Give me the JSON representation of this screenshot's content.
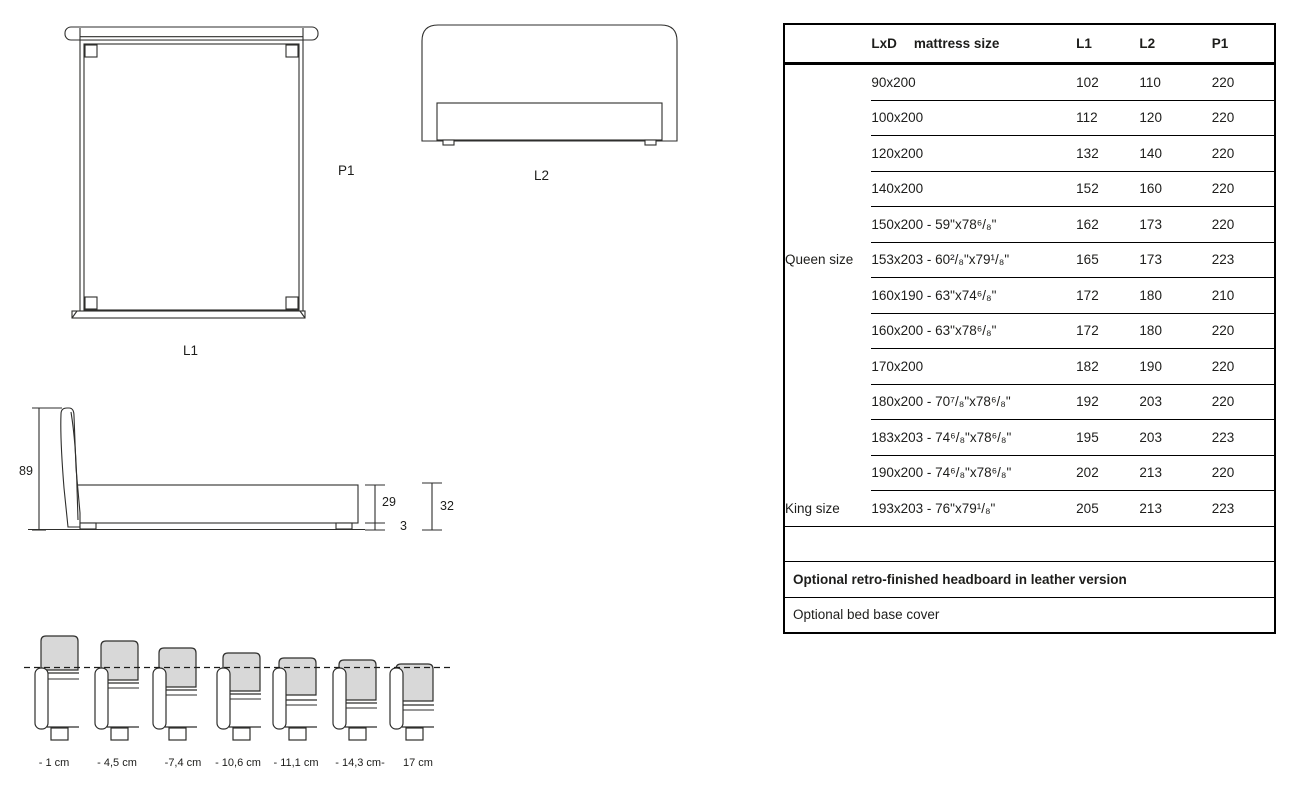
{
  "colors": {
    "ink": "#1d1d1b",
    "line": "#2e2e2c",
    "gray_fill": "#d8d8d8",
    "table_border": "#000000"
  },
  "drawings": {
    "top_view": {
      "bottom_label": "L1",
      "side_label": "P1"
    },
    "front_view": {
      "bottom_label": "L2"
    },
    "side_view": {
      "total_height": "89",
      "base_height": "29",
      "foot_height": "3",
      "base_with_foot": "32"
    }
  },
  "headboard_profiles": {
    "dashed_line_y": 668,
    "items": [
      {
        "label": "- 1 cm",
        "rail_x": 35,
        "gray_top": 636,
        "gray_bottom": 670,
        "seam1": 673,
        "seam2": 679,
        "label_x": 54
      },
      {
        "label": "- 4,5 cm",
        "rail_x": 95,
        "gray_top": 641,
        "gray_bottom": 680,
        "seam1": 683,
        "seam2": 688,
        "label_x": 117
      },
      {
        "label": "-7,4 cm",
        "rail_x": 153,
        "gray_top": 648,
        "gray_bottom": 687,
        "seam1": 690,
        "seam2": 695,
        "label_x": 183
      },
      {
        "label": "- 10,6 cm",
        "rail_x": 217,
        "gray_top": 653,
        "gray_bottom": 691,
        "seam1": 694,
        "seam2": 699,
        "label_x": 238
      },
      {
        "label": "- 11,1 cm",
        "rail_x": 273,
        "gray_top": 658,
        "gray_bottom": 695,
        "seam1": 700,
        "seam2": 705,
        "label_x": 296
      },
      {
        "label": "- 14,3 cm-",
        "rail_x": 333,
        "gray_top": 660,
        "gray_bottom": 700,
        "seam1": 703,
        "seam2": 708,
        "label_x": 360
      },
      {
        "label": "17 cm",
        "rail_x": 390,
        "gray_top": 664,
        "gray_bottom": 701,
        "seam1": 705,
        "seam2": 710,
        "label_x": 418
      }
    ]
  },
  "table": {
    "headers": {
      "dims_prefix": "LxD",
      "dims_label": "mattress size",
      "l1": "L1",
      "l2": "L2",
      "p1": "P1"
    },
    "rows": [
      {
        "group": "",
        "size": "90x200",
        "l1": "102",
        "l2": "110",
        "p1": "220"
      },
      {
        "group": "",
        "size": "100x200",
        "l1": "112",
        "l2": "120",
        "p1": "220"
      },
      {
        "group": "",
        "size": "120x200",
        "l1": "132",
        "l2": "140",
        "p1": "220"
      },
      {
        "group": "",
        "size": "140x200",
        "l1": "152",
        "l2": "160",
        "p1": "220"
      },
      {
        "group": "",
        "size": "150x200 - 59\"x78⁶/₈\"",
        "l1": "162",
        "l2": "173",
        "p1": "220"
      },
      {
        "group": "Queen size",
        "size": "153x203 - 60²/₈\"x79¹/₈\"",
        "l1": "165",
        "l2": "173",
        "p1": "223"
      },
      {
        "group": "",
        "size": "160x190 - 63\"x74⁶/₈\"",
        "l1": "172",
        "l2": "180",
        "p1": "210"
      },
      {
        "group": "",
        "size": "160x200 - 63\"x78⁶/₈\"",
        "l1": "172",
        "l2": "180",
        "p1": "220"
      },
      {
        "group": "",
        "size": "170x200",
        "l1": "182",
        "l2": "190",
        "p1": "220"
      },
      {
        "group": "",
        "size": "180x200 - 70⁷/₈\"x78⁶/₈\"",
        "l1": "192",
        "l2": "203",
        "p1": "220"
      },
      {
        "group": "",
        "size": "183x203 - 74⁶/₈\"x78⁶/₈\"",
        "l1": "195",
        "l2": "203",
        "p1": "223"
      },
      {
        "group": "",
        "size": "190x200 - 74⁶/₈\"x78⁶/₈\"",
        "l1": "202",
        "l2": "213",
        "p1": "220"
      },
      {
        "group": "King size",
        "size": "193x203 - 76\"x79¹/₈\"",
        "l1": "205",
        "l2": "213",
        "p1": "223"
      }
    ],
    "notes": [
      {
        "text": "Optional retro-finished headboard in leather version",
        "bold": true
      },
      {
        "text": "Optional bed base cover",
        "bold": false
      }
    ]
  }
}
